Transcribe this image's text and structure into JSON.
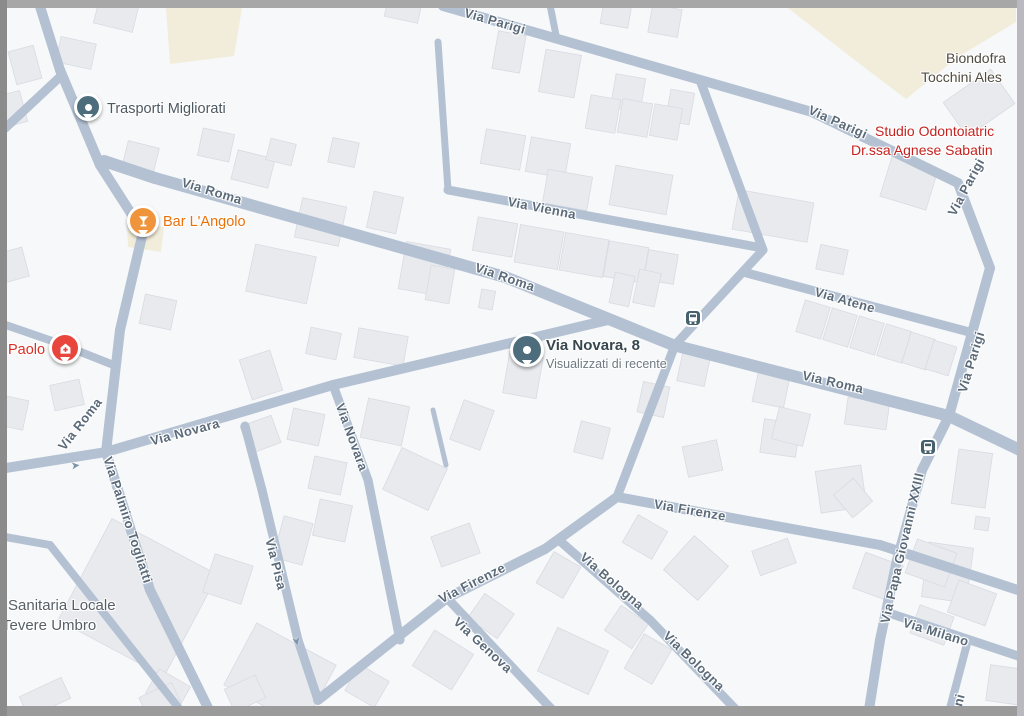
{
  "map": {
    "colors": {
      "background": "#f7f8f9",
      "road": "#b3c1d3",
      "building_fill": "#e8eaee",
      "building_stroke": "#d8dbe2",
      "land_beige": "#f2ecda",
      "street_text": "#5b6a79",
      "frame_top": "#a7a7a7",
      "frame_left": "#8b8b8b",
      "frame_right": "#b9b9bf",
      "frame_bottom": "#9b9b9b",
      "transit_icon": "#46606e",
      "pin_place": "#4e6d7c",
      "pin_bar": "#f0943c",
      "pin_health": "#e8453c"
    },
    "areas": [
      {
        "name": "land-area",
        "points": [
          [
            166,
            8
          ],
          [
            242,
            8
          ],
          [
            234,
            56
          ],
          [
            170,
            64
          ]
        ]
      },
      {
        "name": "land-area",
        "points": [
          [
            788,
            8
          ],
          [
            1016,
            8
          ],
          [
            1016,
            22
          ],
          [
            958,
            57
          ],
          [
            906,
            99
          ],
          [
            852,
            58
          ]
        ]
      },
      {
        "name": "land-area",
        "points": [
          [
            127,
            224
          ],
          [
            164,
            227
          ],
          [
            161,
            252
          ],
          [
            128,
            247
          ]
        ]
      }
    ],
    "roads": [
      [
        443,
        6,
        812,
        112,
        10
      ],
      [
        812,
        112,
        958,
        183,
        10
      ],
      [
        958,
        183,
        990,
        268,
        10
      ],
      [
        990,
        268,
        949,
        416,
        10
      ],
      [
        104,
        161,
        155,
        178,
        12
      ],
      [
        155,
        178,
        505,
        277,
        12
      ],
      [
        505,
        277,
        673,
        345,
        12
      ],
      [
        673,
        345,
        949,
        416,
        12
      ],
      [
        949,
        416,
        1024,
        452,
        12
      ],
      [
        700,
        80,
        763,
        250,
        9
      ],
      [
        763,
        250,
        675,
        345,
        9
      ],
      [
        675,
        345,
        617,
        497,
        9
      ],
      [
        448,
        190,
        757,
        247,
        9
      ],
      [
        448,
        190,
        438,
        42,
        7
      ],
      [
        549,
        0,
        557,
        40,
        7
      ],
      [
        38,
        0,
        60,
        70,
        10
      ],
      [
        60,
        70,
        100,
        165,
        10
      ],
      [
        100,
        165,
        143,
        232,
        10
      ],
      [
        62,
        75,
        0,
        133,
        9
      ],
      [
        143,
        232,
        120,
        330,
        10
      ],
      [
        120,
        330,
        106,
        452,
        10
      ],
      [
        0,
        323,
        58,
        343,
        8
      ],
      [
        58,
        343,
        116,
        366,
        8
      ],
      [
        0,
        469,
        106,
        452,
        10
      ],
      [
        106,
        452,
        333,
        385,
        10
      ],
      [
        333,
        385,
        608,
        320,
        10
      ],
      [
        333,
        385,
        368,
        480,
        9
      ],
      [
        368,
        480,
        400,
        640,
        9
      ],
      [
        106,
        452,
        150,
        590,
        10
      ],
      [
        150,
        590,
        212,
        716,
        10
      ],
      [
        0,
        536,
        50,
        545,
        8
      ],
      [
        50,
        545,
        185,
        716,
        8
      ],
      [
        245,
        426,
        262,
        490,
        9
      ],
      [
        262,
        490,
        298,
        640,
        9
      ],
      [
        298,
        640,
        318,
        700,
        9
      ],
      [
        318,
        700,
        447,
        598,
        10
      ],
      [
        447,
        598,
        545,
        549,
        10
      ],
      [
        545,
        549,
        617,
        497,
        10
      ],
      [
        617,
        497,
        880,
        545,
        10
      ],
      [
        880,
        545,
        1024,
        592,
        10
      ],
      [
        447,
        598,
        510,
        665,
        9
      ],
      [
        510,
        665,
        558,
        716,
        9
      ],
      [
        560,
        541,
        650,
        620,
        9
      ],
      [
        650,
        620,
        742,
        716,
        9
      ],
      [
        743,
        272,
        973,
        333,
        9
      ],
      [
        949,
        416,
        922,
        470,
        10
      ],
      [
        922,
        470,
        897,
        560,
        10
      ],
      [
        897,
        560,
        880,
        640,
        10
      ],
      [
        880,
        640,
        868,
        716,
        10
      ],
      [
        886,
        612,
        1024,
        658,
        9
      ],
      [
        968,
        640,
        948,
        716,
        8
      ],
      [
        433,
        410,
        446,
        465,
        5
      ]
    ],
    "buildings": [
      [
        12,
        48,
        26,
        34,
        -15
      ],
      [
        58,
        40,
        36,
        26,
        12
      ],
      [
        96,
        2,
        40,
        26,
        14
      ],
      [
        0,
        93,
        24,
        32,
        -15
      ],
      [
        386,
        0,
        34,
        20,
        12
      ],
      [
        200,
        131,
        32,
        28,
        12
      ],
      [
        124,
        144,
        32,
        32,
        14
      ],
      [
        234,
        154,
        38,
        30,
        14
      ],
      [
        268,
        141,
        26,
        22,
        14
      ],
      [
        330,
        140,
        27,
        25,
        12
      ],
      [
        298,
        202,
        45,
        40,
        12
      ],
      [
        370,
        194,
        30,
        37,
        12
      ],
      [
        250,
        250,
        62,
        48,
        12
      ],
      [
        402,
        245,
        45,
        48,
        10
      ],
      [
        428,
        267,
        24,
        35,
        10
      ],
      [
        142,
        297,
        32,
        30,
        12
      ],
      [
        0,
        250,
        26,
        30,
        -15
      ],
      [
        52,
        382,
        30,
        26,
        -12
      ],
      [
        2,
        398,
        24,
        30,
        12
      ],
      [
        602,
        2,
        28,
        24,
        10
      ],
      [
        650,
        7,
        30,
        28,
        10
      ],
      [
        495,
        33,
        28,
        38,
        10
      ],
      [
        542,
        52,
        36,
        43,
        10
      ],
      [
        613,
        76,
        30,
        34,
        10
      ],
      [
        668,
        91,
        24,
        32,
        10
      ],
      [
        588,
        97,
        30,
        34,
        10
      ],
      [
        620,
        101,
        30,
        34,
        10
      ],
      [
        652,
        106,
        28,
        32,
        10
      ],
      [
        483,
        132,
        40,
        35,
        10
      ],
      [
        528,
        140,
        40,
        35,
        10
      ],
      [
        545,
        173,
        45,
        34,
        10
      ],
      [
        612,
        170,
        58,
        40,
        10
      ],
      [
        475,
        220,
        40,
        34,
        10
      ],
      [
        517,
        228,
        44,
        38,
        10
      ],
      [
        562,
        236,
        44,
        38,
        10
      ],
      [
        606,
        244,
        40,
        36,
        10
      ],
      [
        646,
        252,
        30,
        30,
        10
      ],
      [
        950,
        82,
        58,
        42,
        -35
      ],
      [
        885,
        162,
        48,
        42,
        17
      ],
      [
        735,
        196,
        76,
        40,
        10
      ],
      [
        818,
        247,
        28,
        25,
        12
      ],
      [
        800,
        303,
        26,
        33,
        17
      ],
      [
        827,
        311,
        26,
        33,
        17
      ],
      [
        854,
        319,
        26,
        33,
        17
      ],
      [
        881,
        327,
        26,
        33,
        17
      ],
      [
        906,
        335,
        25,
        32,
        17
      ],
      [
        929,
        343,
        24,
        30,
        17
      ],
      [
        846,
        400,
        42,
        27,
        8
      ],
      [
        762,
        421,
        36,
        34,
        8
      ],
      [
        612,
        274,
        20,
        31,
        12
      ],
      [
        636,
        271,
        22,
        34,
        12
      ],
      [
        680,
        350,
        28,
        34,
        12
      ],
      [
        755,
        374,
        32,
        31,
        12
      ],
      [
        640,
        384,
        27,
        31,
        12
      ],
      [
        506,
        354,
        34,
        42,
        10
      ],
      [
        480,
        290,
        14,
        19,
        10
      ],
      [
        308,
        330,
        31,
        27,
        12
      ],
      [
        356,
        332,
        50,
        30,
        10
      ],
      [
        245,
        354,
        32,
        42,
        -18
      ],
      [
        290,
        411,
        32,
        32,
        12
      ],
      [
        244,
        420,
        33,
        29,
        -20
      ],
      [
        364,
        402,
        42,
        40,
        12
      ],
      [
        390,
        456,
        50,
        46,
        25
      ],
      [
        456,
        404,
        32,
        42,
        20
      ],
      [
        311,
        459,
        33,
        33,
        12
      ],
      [
        316,
        502,
        33,
        37,
        12
      ],
      [
        278,
        519,
        30,
        43,
        15
      ],
      [
        577,
        424,
        30,
        32,
        14
      ],
      [
        685,
        443,
        35,
        31,
        -12
      ],
      [
        775,
        410,
        32,
        33,
        14
      ],
      [
        818,
        468,
        46,
        42,
        -8
      ],
      [
        925,
        545,
        45,
        55,
        8
      ],
      [
        955,
        451,
        34,
        55,
        8
      ],
      [
        975,
        517,
        14,
        13,
        8
      ],
      [
        988,
        667,
        35,
        36,
        8
      ],
      [
        840,
        483,
        26,
        30,
        -40
      ],
      [
        435,
        529,
        41,
        32,
        -20
      ],
      [
        543,
        557,
        31,
        36,
        30
      ],
      [
        628,
        521,
        34,
        32,
        30
      ],
      [
        755,
        544,
        38,
        26,
        -20
      ],
      [
        673,
        545,
        46,
        46,
        42
      ],
      [
        858,
        558,
        40,
        38,
        20
      ],
      [
        910,
        545,
        42,
        36,
        20
      ],
      [
        952,
        586,
        40,
        34,
        20
      ],
      [
        914,
        610,
        36,
        30,
        20
      ],
      [
        610,
        612,
        33,
        30,
        34
      ],
      [
        632,
        639,
        32,
        40,
        30
      ],
      [
        545,
        637,
        56,
        48,
        25
      ],
      [
        420,
        639,
        46,
        42,
        32
      ],
      [
        350,
        671,
        34,
        30,
        30
      ],
      [
        473,
        601,
        36,
        30,
        35
      ],
      [
        78,
        540,
        120,
        115,
        28
      ],
      [
        235,
        640,
        90,
        70,
        28
      ],
      [
        208,
        559,
        40,
        40,
        18
      ],
      [
        150,
        676,
        36,
        28,
        30
      ],
      [
        228,
        681,
        34,
        25,
        -25
      ],
      [
        142,
        689,
        36,
        23,
        -25
      ],
      [
        22,
        686,
        46,
        23,
        -25
      ]
    ],
    "street_labels": [
      {
        "text": "Via Parigi",
        "x": 495,
        "y": 21,
        "rot": 16
      },
      {
        "text": "Via Parigi",
        "x": 838,
        "y": 122,
        "rot": 24
      },
      {
        "text": "Via Parigi",
        "x": 966,
        "y": 187,
        "rot": -62
      },
      {
        "text": "Via Parigi",
        "x": 971,
        "y": 362,
        "rot": -73
      },
      {
        "text": "Via Roma",
        "x": 212,
        "y": 191,
        "rot": 17
      },
      {
        "text": "Via Roma",
        "x": 505,
        "y": 277,
        "rot": 19
      },
      {
        "text": "Via Roma",
        "x": 833,
        "y": 382,
        "rot": 13
      },
      {
        "text": "Via Roma",
        "x": 80,
        "y": 424,
        "rot": -52
      },
      {
        "text": "Via Vienna",
        "x": 542,
        "y": 208,
        "rot": 11
      },
      {
        "text": "Via Atene",
        "x": 845,
        "y": 300,
        "rot": 16
      },
      {
        "text": "Via Novara",
        "x": 185,
        "y": 432,
        "rot": -15
      },
      {
        "text": "Via Novara",
        "x": 352,
        "y": 437,
        "rot": 70
      },
      {
        "text": "Via Palmiro Togliatti",
        "x": 128,
        "y": 520,
        "rot": 72
      },
      {
        "text": "Via Pisa",
        "x": 276,
        "y": 564,
        "rot": 76
      },
      {
        "text": "Via Firenze",
        "x": 472,
        "y": 583,
        "rot": -27
      },
      {
        "text": "Via Firenze",
        "x": 690,
        "y": 510,
        "rot": 10
      },
      {
        "text": "Via Bologna",
        "x": 612,
        "y": 581,
        "rot": 41
      },
      {
        "text": "Via Bologna",
        "x": 694,
        "y": 661,
        "rot": 44
      },
      {
        "text": "Via Genova",
        "x": 483,
        "y": 645,
        "rot": 43
      },
      {
        "text": "Via Papa Giovanni XXIII",
        "x": 902,
        "y": 548,
        "rot": -77
      },
      {
        "text": "Via Milano",
        "x": 936,
        "y": 632,
        "rot": 17
      },
      {
        "text": "ni",
        "x": 959,
        "y": 700,
        "rot": -75
      }
    ],
    "poi_labels": [
      {
        "id": "trasporti-migliorati",
        "x": 107,
        "y": 100,
        "lines": [
          {
            "text": "Trasporti Migliorati",
            "color": "#4d5962",
            "size": 14.5,
            "weight": "normal"
          }
        ]
      },
      {
        "id": "bar-langolo",
        "x": 163,
        "y": 213,
        "lines": [
          {
            "text": "Bar L'Angolo",
            "color": "#e8710a",
            "size": 14.5,
            "weight": "normal"
          }
        ]
      },
      {
        "id": "paolo",
        "x": 8,
        "y": 341,
        "lines": [
          {
            "text": "Paolo",
            "color": "#d93025",
            "size": 14.5,
            "weight": "normal"
          }
        ]
      },
      {
        "id": "via-novara-8",
        "x": 546,
        "y": 336,
        "lines": [
          {
            "text": "Via Novara, 8",
            "color": "#37474f",
            "size": 15,
            "weight": "bold"
          },
          {
            "text": "Visualizzati di recente",
            "color": "#6f7a82",
            "size": 12.5,
            "weight": "normal"
          }
        ]
      },
      {
        "id": "biondofra",
        "x": 946,
        "y": 49,
        "lines": [
          {
            "text": "Biondofra",
            "color": "#514b41",
            "size": 14,
            "weight": "normal"
          }
        ]
      },
      {
        "id": "tocchini",
        "x": 921,
        "y": 68,
        "lines": [
          {
            "text": "Tocchini Ales",
            "color": "#514b41",
            "size": 14,
            "weight": "normal"
          }
        ]
      },
      {
        "id": "studio-odontoiatrico",
        "x": 875,
        "y": 122,
        "lines": [
          {
            "text": "Studio Odontoiatric",
            "color": "#c5221f",
            "size": 14,
            "weight": "normal"
          }
        ]
      },
      {
        "id": "drssa-sabatini",
        "x": 851,
        "y": 141,
        "lines": [
          {
            "text": "Dr.ssa Agnese Sabatin",
            "color": "#c5221f",
            "size": 14,
            "weight": "normal"
          }
        ]
      },
      {
        "id": "sanitaria-locale",
        "x": 8,
        "y": 596,
        "lines": [
          {
            "text": "Sanitaria Locale",
            "color": "#575f66",
            "size": 15,
            "weight": "normal"
          }
        ]
      },
      {
        "id": "tevere-umbro",
        "x": 2,
        "y": 616,
        "lines": [
          {
            "text": "Tevere Umbro",
            "color": "#575f66",
            "size": 15,
            "weight": "normal"
          }
        ]
      }
    ],
    "markers": [
      {
        "type": "place",
        "name": "trasporti-migliorati-pin",
        "x": 88,
        "y": 107,
        "size": 22
      },
      {
        "type": "bar",
        "name": "bar-langolo-pin",
        "x": 143,
        "y": 221,
        "size": 26
      },
      {
        "type": "health",
        "name": "paolo-pin",
        "x": 65,
        "y": 348,
        "size": 26
      },
      {
        "type": "place",
        "name": "via-novara-8-pin",
        "x": 527,
        "y": 350,
        "size": 28
      }
    ],
    "transit_stops": [
      {
        "x": 693,
        "y": 318
      },
      {
        "x": 928,
        "y": 447
      }
    ],
    "arrows": [
      {
        "x": 76,
        "y": 466,
        "rot": -6
      },
      {
        "x": 296,
        "y": 641,
        "rot": 78
      }
    ],
    "arrow_glyph": "➤"
  }
}
